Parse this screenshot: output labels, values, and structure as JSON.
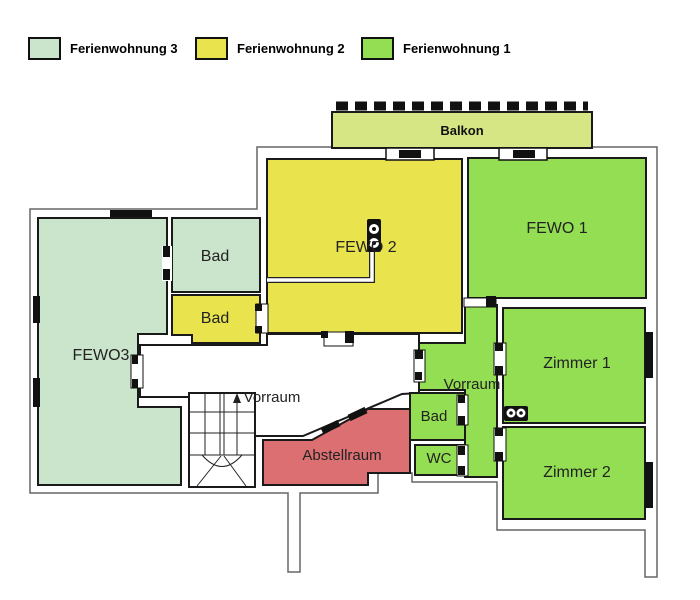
{
  "legend": {
    "items": [
      {
        "label": "Ferienwohnung 3",
        "color": "#cbe5cc"
      },
      {
        "label": "Ferienwohnung 2",
        "color": "#e9e44e"
      },
      {
        "label": "Ferienwohnung 1",
        "color": "#93de52"
      }
    ]
  },
  "floorplan": {
    "rooms": [
      {
        "id": "balkon",
        "label": "Balkon",
        "color": "#d7e685"
      },
      {
        "id": "fewo3",
        "label": "FEWO3",
        "color": "#cbe5cc"
      },
      {
        "id": "bad-top",
        "label": "Bad",
        "color": "#cbe5cc"
      },
      {
        "id": "bad-mid",
        "label": "Bad",
        "color": "#e9e44e"
      },
      {
        "id": "fewo2",
        "label": "FEWO 2",
        "color": "#e9e44e"
      },
      {
        "id": "fewo1",
        "label": "FEWO 1",
        "color": "#93de52"
      },
      {
        "id": "vorraum-main",
        "label": "Vorraum",
        "color": "#ffffff"
      },
      {
        "id": "vorraum-right",
        "label": "Vorraum",
        "color": "#93de52"
      },
      {
        "id": "zimmer1",
        "label": "Zimmer 1",
        "color": "#93de52"
      },
      {
        "id": "zimmer2",
        "label": "Zimmer 2",
        "color": "#93de52"
      },
      {
        "id": "bad-right",
        "label": "Bad",
        "color": "#93de52"
      },
      {
        "id": "wc",
        "label": "WC",
        "color": "#93de52"
      },
      {
        "id": "abstellraum",
        "label": "Abstellraum",
        "color": "#dc6f72"
      }
    ],
    "colors": {
      "wall": "#1a1a1a",
      "outline": "#666666",
      "background": "#ffffff"
    }
  }
}
